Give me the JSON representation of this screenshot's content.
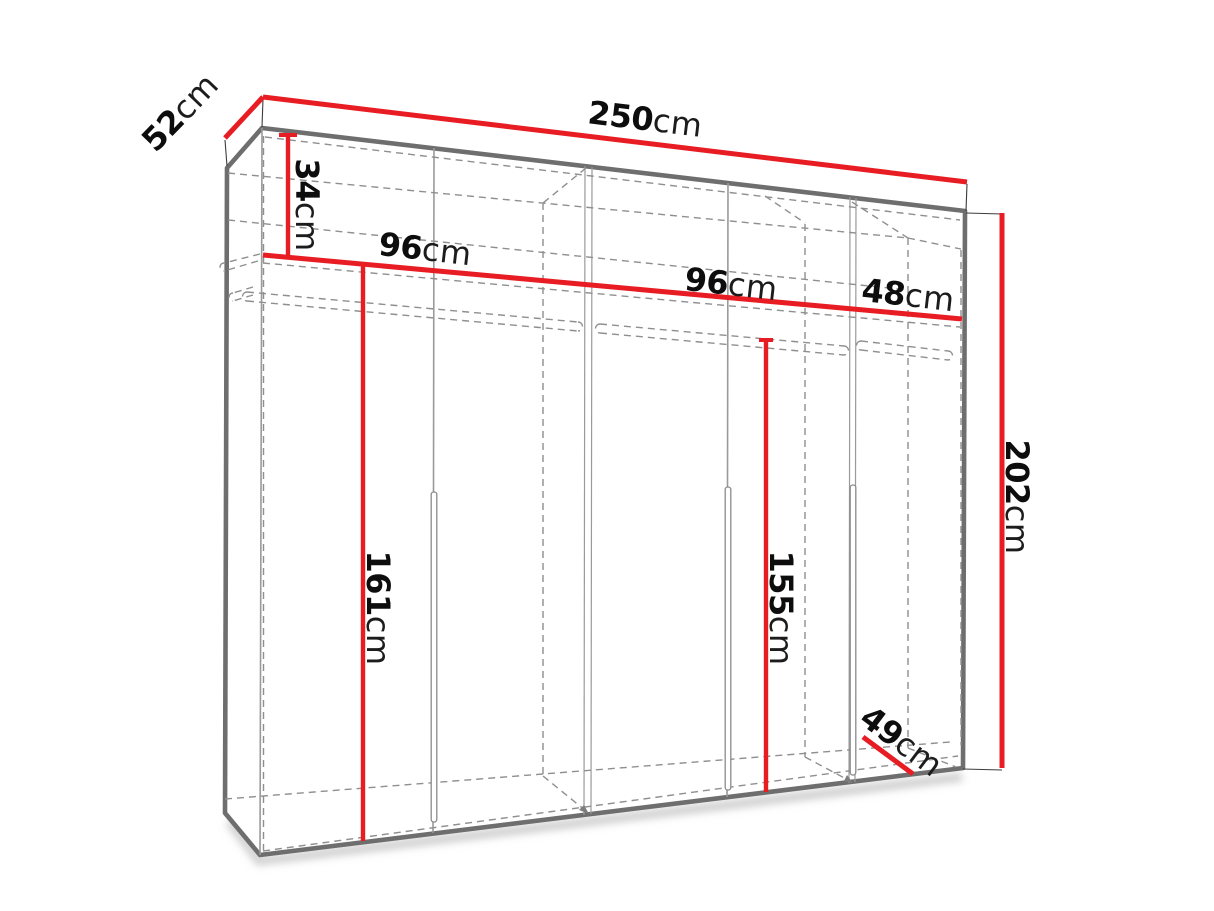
{
  "diagram": {
    "title": "wardrobe-dimension-diagram",
    "unit": "cm",
    "colors": {
      "dimension_line": "#e81d23",
      "outline": "#6e6e6e",
      "panel_line": "#9a9a9a",
      "dashed_line": "#8f8f8f",
      "label": "#0d0d0d"
    },
    "dimensions": {
      "width": {
        "value": "250",
        "unit": "cm"
      },
      "depth": {
        "value": "52",
        "unit": "cm"
      },
      "top_shelf_drop": {
        "value": "34",
        "unit": "cm"
      },
      "left_section_width": {
        "value": "96",
        "unit": "cm"
      },
      "middle_section_width": {
        "value": "96",
        "unit": "cm"
      },
      "right_section_width": {
        "value": "48",
        "unit": "cm"
      },
      "left_hanging_height": {
        "value": "161",
        "unit": "cm"
      },
      "middle_hanging_height": {
        "value": "155",
        "unit": "cm"
      },
      "total_height": {
        "value": "202",
        "unit": "cm"
      },
      "right_section_depth": {
        "value": "49",
        "unit": "cm"
      }
    }
  }
}
